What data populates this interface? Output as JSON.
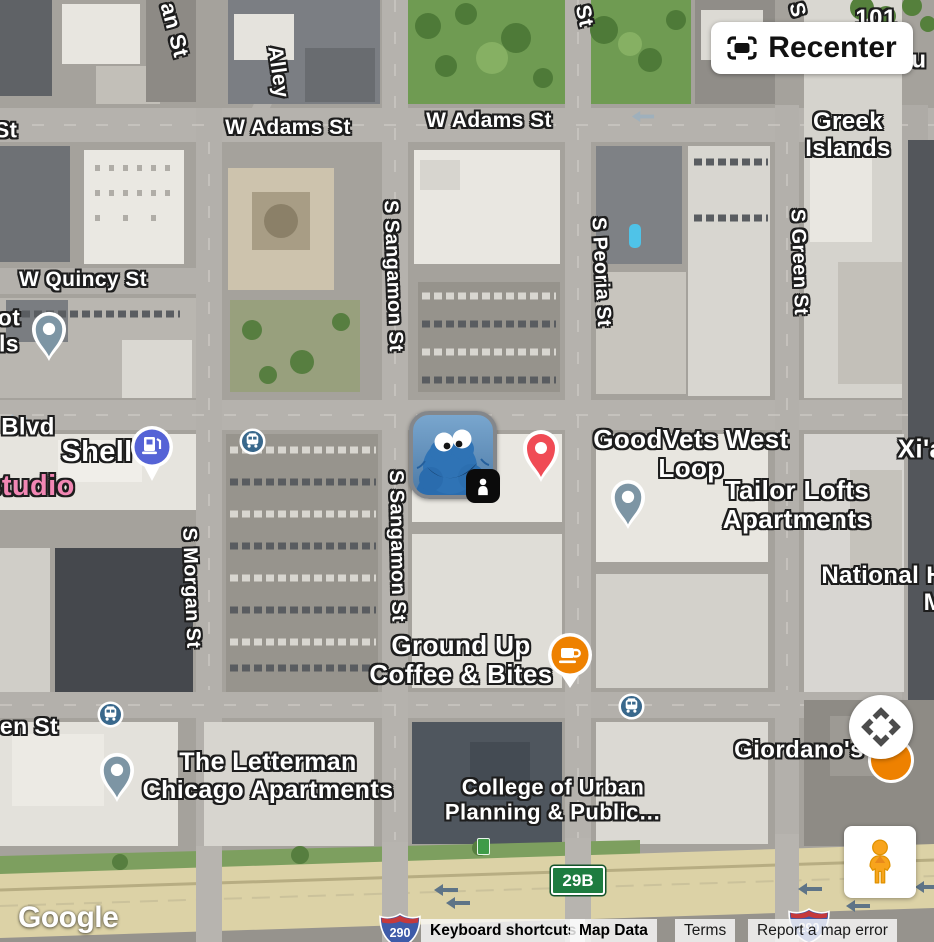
{
  "colors": {
    "red_pin": "#F04B55",
    "orange_marker": "#EE8100",
    "slate_pin": "#7D95A4",
    "gas_blue": "#5563D6",
    "transit": "#39688C",
    "exit_green": "#1E7C40",
    "interstate_blue": "#3E5BA9",
    "interstate_red": "#C5393C",
    "pegman_orange": "#F8A41C",
    "pink_label": "#F287B4",
    "highway_arrow": "#5E7487"
  },
  "map": {
    "streets": [
      {
        "text": "an St"
      },
      {
        "text": "Alley"
      },
      {
        "text": "W Adams St"
      },
      {
        "text": "W Adams St"
      },
      {
        "text": "St"
      },
      {
        "text": "S"
      },
      {
        "text": "W Quincy St"
      },
      {
        "text": "S Sangamon St"
      },
      {
        "text": "S Peoria St"
      },
      {
        "text": "S Green St"
      },
      {
        "text": "Blvd"
      },
      {
        "text": "S Morgan St"
      },
      {
        "text": "S Sangamon St"
      },
      {
        "text": "en St"
      },
      {
        "text": "St"
      },
      {
        "text": "ot\nls"
      }
    ],
    "places": [
      {
        "text": "Greek Islands"
      },
      {
        "text": "GoodVets West Loop"
      },
      {
        "text": "Tailor Lofts Apartments"
      },
      {
        "text": "Xi'a"
      },
      {
        "text": "National H\nM"
      },
      {
        "text": "Ground Up\nCoffee & Bites"
      },
      {
        "text": "Giordano's"
      },
      {
        "text": "The Letterman\nChicago Apartments"
      },
      {
        "text": "College of Urban\nPlanning & Public…"
      },
      {
        "text": "Shell"
      },
      {
        "text": "studio"
      },
      {
        "text": "101 S H"
      },
      {
        "text": "Secu"
      }
    ],
    "shields": {
      "exit": "29B",
      "interstate": "290"
    },
    "markers": [
      {
        "name": "user-avatar-cookie-monster",
        "type": "avatar-photo",
        "badge": "street-view-person"
      },
      {
        "name": "goodvets-pin",
        "type": "saved-place-pin",
        "color": "#F04B55"
      },
      {
        "name": "ground-up-coffee-pin",
        "type": "cafe-pin",
        "color": "#EE8100"
      },
      {
        "name": "tailor-lofts-pin",
        "type": "lodging-pin",
        "color": "#7D95A4"
      },
      {
        "name": "letterman-pin",
        "type": "lodging-pin",
        "color": "#7D95A4"
      },
      {
        "name": "west-lot-pin",
        "type": "lodging-pin",
        "color": "#7D95A4"
      },
      {
        "name": "shell-gas-pin",
        "type": "gas-station-pin",
        "color": "#5563D6"
      },
      {
        "name": "bus-stop-icon",
        "type": "transit-bus",
        "color": "#39688C",
        "count": 3
      },
      {
        "name": "giordanos-pin-partial",
        "type": "restaurant-pin",
        "color": "#EE8100"
      }
    ]
  },
  "controls": {
    "recenter_label": "Recenter",
    "icons": {
      "recenter": "center-frame-icon",
      "pan": "four-direction-arrows-icon",
      "pegman": "street-view-pegman-icon"
    }
  },
  "footer": {
    "logo": "Google",
    "links": [
      {
        "label": "Keyboard shortcuts"
      },
      {
        "label": "Map Data"
      },
      {
        "label": "Terms"
      },
      {
        "label": "Report a map error"
      }
    ]
  }
}
